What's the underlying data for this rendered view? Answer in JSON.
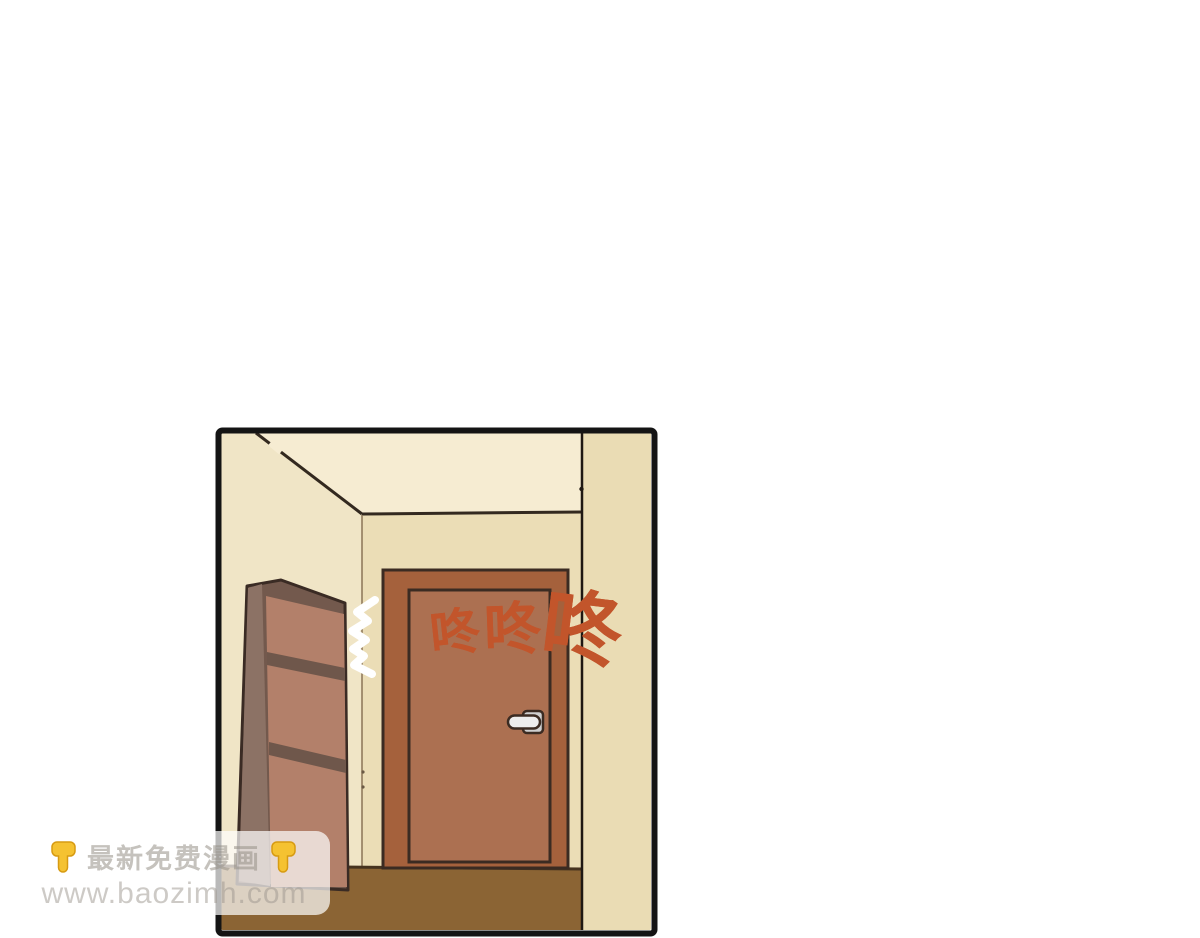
{
  "page": {
    "background_color": "#ffffff",
    "type": "comic-reader-page"
  },
  "panel": {
    "border_color": "#141414",
    "scene": "hallway interior with closed door and drawer cabinet",
    "colors": {
      "ceiling": "#F6ECD2",
      "left_wall": "#F0E5C6",
      "facing_wall": "#EBDDB6",
      "right_wall": "#EADCB4",
      "floor": "#8B6434",
      "door_frame": "#A5613C",
      "door_panel": "#AC7051",
      "door_handle": "#E9E9E9",
      "shelf_side": "#8C7265",
      "shelf_front": "#B3806A",
      "shelf_divider": "#6F574B",
      "sfx_color": "#C2552B",
      "outline": "#3B2B22"
    },
    "sfx": {
      "text": "咚咚咚",
      "meaning": "knock knock knock",
      "chars": [
        "咚",
        "咚",
        "咚"
      ]
    }
  },
  "watermark": {
    "line1": "最新免费漫画",
    "line2": "www.baozimh.com",
    "emoji_left": "backhand-index-pointing-down",
    "emoji_right": "backhand-index-pointing-down",
    "emoji_color": "#F5C231"
  }
}
